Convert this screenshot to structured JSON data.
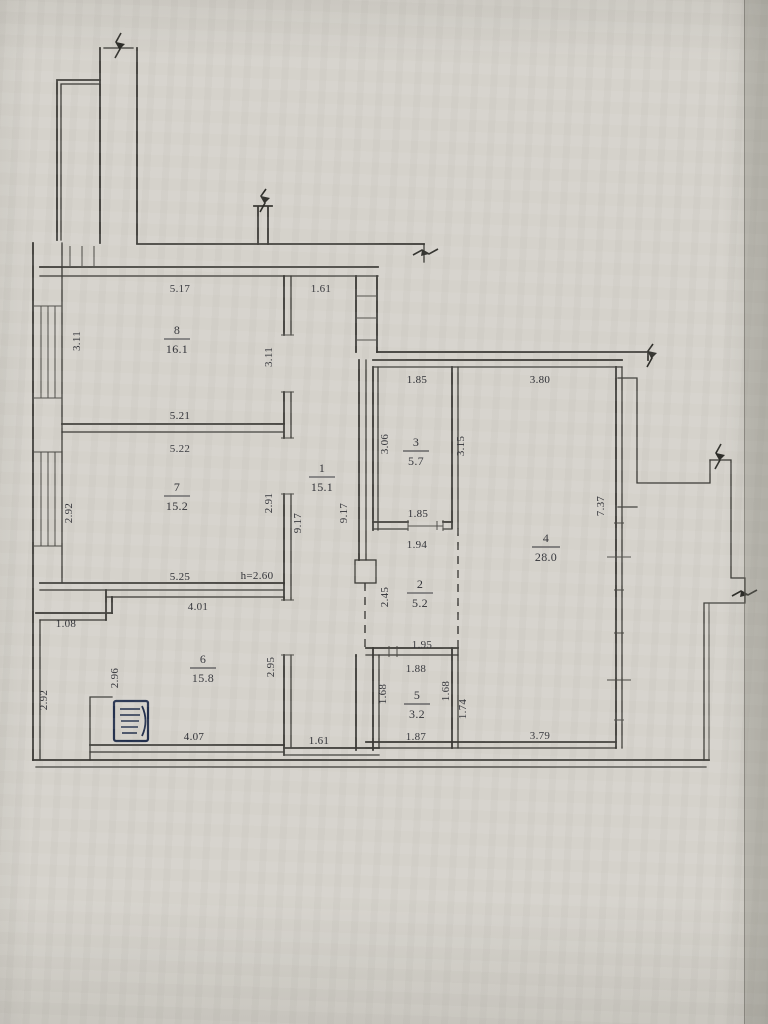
{
  "document": {
    "kind": "scanned apartment floor plan",
    "paper_color": "#d5d2cb",
    "ink_color": "#2f3036",
    "height_note": "h=2.60"
  },
  "plan": {
    "rooms": [
      {
        "name": "hallway",
        "number": "1",
        "area": "15.1",
        "dims": {
          "top": "1.61",
          "left": "9.17",
          "right": "9.17",
          "bottom": "1.61"
        }
      },
      {
        "name": "niche",
        "number": "2",
        "area": "5.2",
        "dims": {
          "top": "1.94",
          "left": "2.45",
          "bottom": "1.95"
        }
      },
      {
        "name": "small-room",
        "number": "3",
        "area": "5.7",
        "dims": {
          "top": "1.85",
          "left": "3.06",
          "bottom": "1.85"
        }
      },
      {
        "name": "living-room",
        "number": "4",
        "area": "28.0",
        "dims": {
          "top": "3.80",
          "left": "3.15",
          "right": "7.37",
          "bottom": "3.79"
        }
      },
      {
        "name": "bathroom",
        "number": "5",
        "area": "3.2",
        "dims": {
          "top": "1.88",
          "left": "1.68",
          "right": "1.68",
          "bottom": "1.87",
          "outer_right": "1.74"
        }
      },
      {
        "name": "kitchen",
        "number": "6",
        "area": "15.8",
        "dims": {
          "top": "4.01",
          "left": "2.96",
          "left_outer": "2.92",
          "right": "2.95",
          "bottom": "4.07",
          "step": "1.08"
        }
      },
      {
        "name": "bedroom",
        "number": "7",
        "area": "15.2",
        "dims": {
          "top": "5.22",
          "left": "2.92",
          "right": "2.91",
          "bottom": "5.25"
        },
        "height_note": "h=2.60"
      },
      {
        "name": "bedroom-2",
        "number": "8",
        "area": "16.1",
        "dims": {
          "top": "5.17",
          "left": "3.11",
          "right": "3.11",
          "bottom": "5.21"
        }
      }
    ]
  }
}
